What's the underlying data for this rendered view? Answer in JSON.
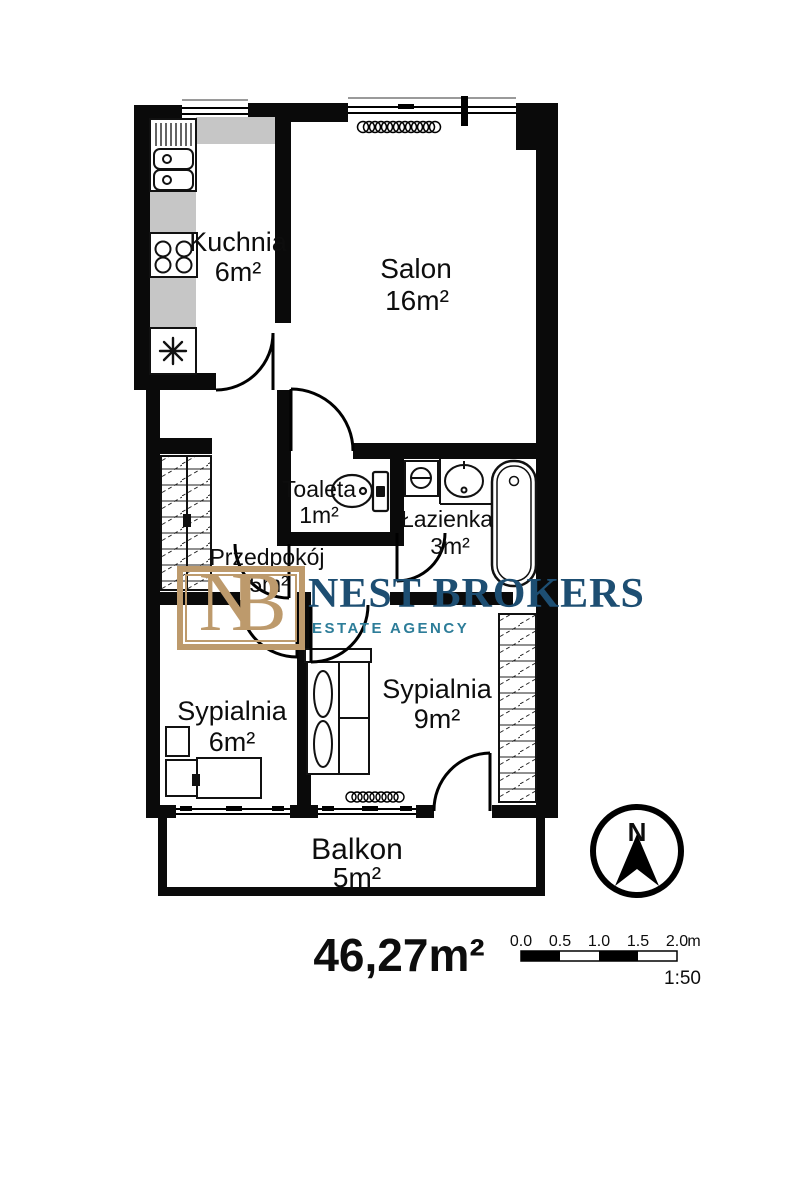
{
  "plan": {
    "rooms": [
      {
        "id": "kuchnia",
        "name": "Kuchnia",
        "area": "6m²"
      },
      {
        "id": "salon",
        "name": "Salon",
        "area": "16m²"
      },
      {
        "id": "toaleta",
        "name": "Toaleta",
        "area": "1m²"
      },
      {
        "id": "lazienka",
        "name": "Łazienka",
        "area": "3m²"
      },
      {
        "id": "przedpokoj",
        "name": "Przedpokój",
        "area": "5m²"
      },
      {
        "id": "sypialnia-mala",
        "name": "Sypialnia",
        "area": "6m²"
      },
      {
        "id": "sypialnia-duza",
        "name": "Sypialnia",
        "area": "9m²"
      },
      {
        "id": "balkon",
        "name": "Balkon",
        "area": "5m²"
      }
    ],
    "total_area": "46,27m²"
  },
  "logo": {
    "monogram": "NB",
    "name": "NEST BROKERS",
    "tagline": "ESTATE AGENCY",
    "colors": {
      "gold": "#bd9a6c",
      "navy": "#1d4e72",
      "teal": "#2d7d99"
    }
  },
  "compass": {
    "north_label": "N"
  },
  "scale_bar": {
    "ticks": [
      "0.0",
      "0.5",
      "1.0",
      "1.5",
      "2.0"
    ],
    "unit": "m",
    "ratio_label": "1:50"
  }
}
